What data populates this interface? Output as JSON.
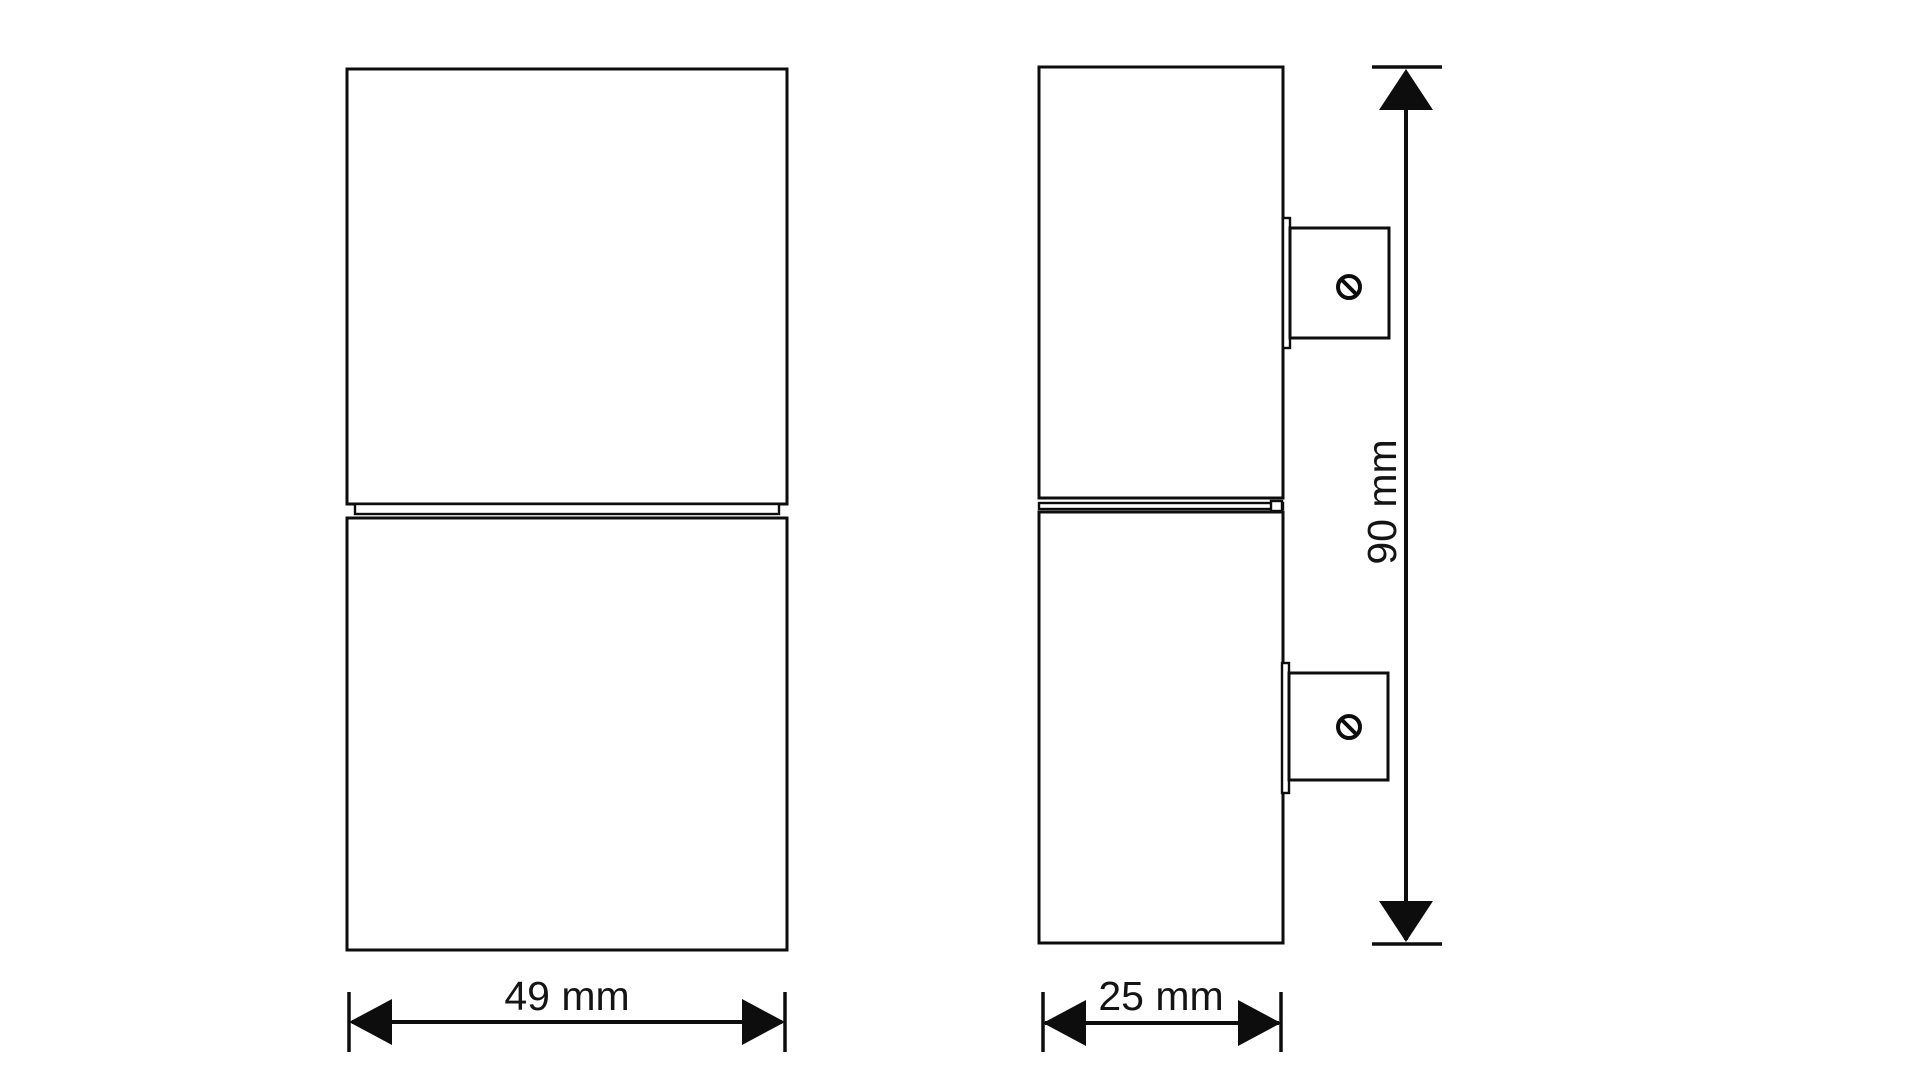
{
  "drawing": {
    "type": "technical-dimension-drawing",
    "background_color": "#ffffff",
    "line_color": "#0d0d0d",
    "text_color": "#141414",
    "views": {
      "front": {
        "description": "front view, two stacked cylinder sections"
      },
      "side": {
        "description": "side view with two wall-mount brackets and screw symbols"
      }
    },
    "dimensions": {
      "width": {
        "label": "49 mm",
        "value": 49,
        "unit": "mm",
        "orientation": "horizontal"
      },
      "depth": {
        "label": "25 mm",
        "value": 25,
        "unit": "mm",
        "orientation": "horizontal"
      },
      "height": {
        "label": "90 mm",
        "value": 90,
        "unit": "mm",
        "orientation": "vertical"
      }
    },
    "icons": {
      "screw_top": "screw-slot-icon",
      "screw_bottom": "screw-slot-icon"
    }
  }
}
